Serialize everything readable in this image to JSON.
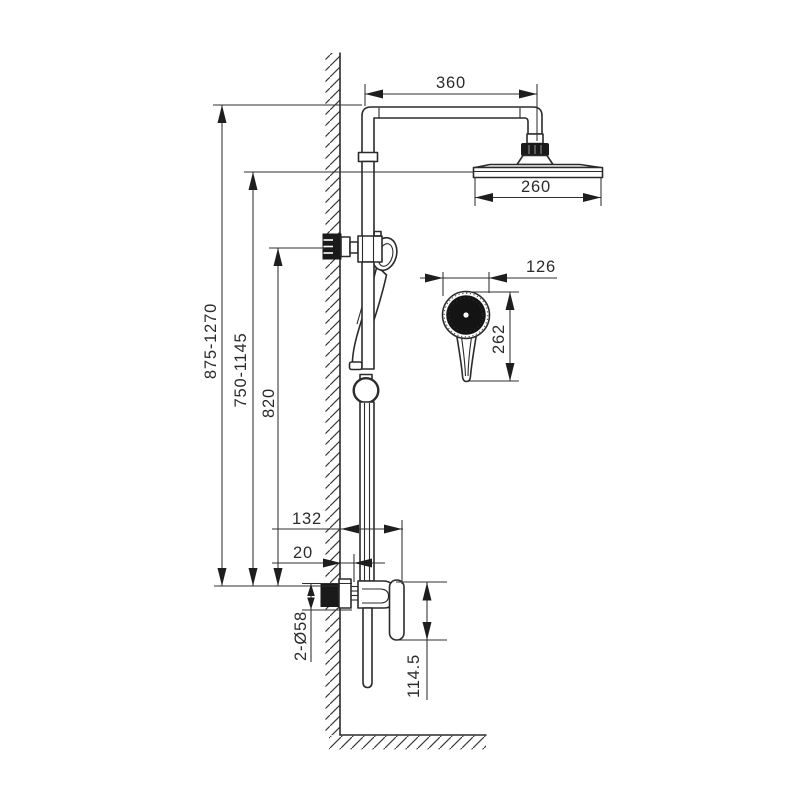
{
  "drawing": {
    "type": "technical installation drawing",
    "subject": "wall-mounted shower column with overhead rain shower, hand shower and mixer valve",
    "background_color": "#ffffff",
    "line_color": "#2b2b2b",
    "dark_fill_color": "#1a1a1a"
  },
  "dimensions": {
    "overhead_arm_reach": "360",
    "rain_head_diameter": "260",
    "hand_shower_diameter": "126",
    "hand_shower_length": "262",
    "overall_height_range": "875-1270",
    "head_height_range": "750-1145",
    "bracket_height": "820",
    "valve_projection": "132",
    "wall_offset": "20",
    "escutcheon_diameter": "2-Ø58",
    "valve_body_height": "114.5"
  }
}
